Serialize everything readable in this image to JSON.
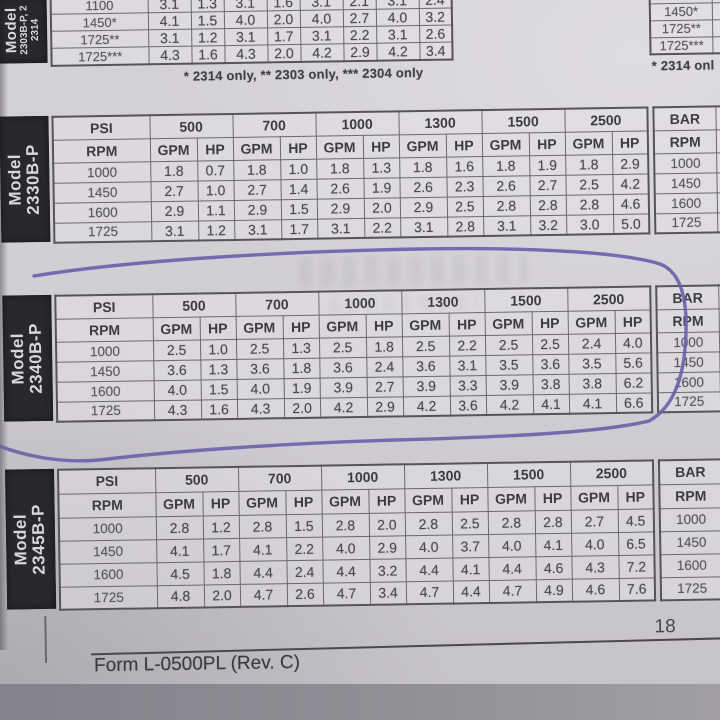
{
  "labels": {
    "psi": "PSI",
    "rpm": "RPM",
    "gpm": "GPM",
    "hp": "HP",
    "bar": "BAR"
  },
  "footnotes": {
    "top_left": "* 2314 only, ** 2303 only, *** 2304 only",
    "top_right_partial": "* 2314 onl"
  },
  "footer": {
    "form_text": "Form L-0500PL (Rev. C)",
    "page_number": "18"
  },
  "annotation": {
    "type": "hand-drawn pen circle",
    "color": "#6e62aa",
    "target": "Model 2340B-P table"
  },
  "tables": {
    "top": {
      "model_lines": [
        "Model",
        "2303B-P, 2",
        "2314"
      ],
      "rows": [
        {
          "rpm": "1100",
          "values": [
            "3.1",
            "1.3",
            "3.1",
            "1.6",
            "3.1",
            "2.1",
            "3.1",
            "2.4"
          ]
        },
        {
          "rpm": "1450*",
          "values": [
            "4.1",
            "1.5",
            "4.0",
            "2.0",
            "4.0",
            "2.7",
            "4.0",
            "3.2"
          ]
        },
        {
          "rpm": "1725**",
          "values": [
            "3.1",
            "1.2",
            "3.1",
            "1.7",
            "3.1",
            "2.2",
            "3.1",
            "2.6"
          ]
        },
        {
          "rpm": "1725***",
          "values": [
            "4.3",
            "1.6",
            "4.3",
            "2.0",
            "4.2",
            "2.9",
            "4.2",
            "3.4"
          ]
        }
      ]
    },
    "top_right": {
      "rpm_only_rows": [
        "",
        "1450*",
        "1725**",
        "1725***"
      ]
    },
    "t2330": {
      "model_lines": [
        "Model",
        "2330B-P"
      ],
      "pressures": [
        "500",
        "700",
        "1000",
        "1300",
        "1500",
        "2500"
      ],
      "rows": [
        {
          "rpm": "1000",
          "values": [
            "1.8",
            "0.7",
            "1.8",
            "1.0",
            "1.8",
            "1.3",
            "1.8",
            "1.6",
            "1.8",
            "1.9",
            "1.8",
            "2.9"
          ]
        },
        {
          "rpm": "1450",
          "values": [
            "2.7",
            "1.0",
            "2.7",
            "1.4",
            "2.6",
            "1.9",
            "2.6",
            "2.3",
            "2.6",
            "2.7",
            "2.5",
            "4.2"
          ]
        },
        {
          "rpm": "1600",
          "values": [
            "2.9",
            "1.1",
            "2.9",
            "1.5",
            "2.9",
            "2.0",
            "2.9",
            "2.5",
            "2.8",
            "2.8",
            "2.8",
            "4.6"
          ]
        },
        {
          "rpm": "1725",
          "values": [
            "3.1",
            "1.2",
            "3.1",
            "1.7",
            "3.1",
            "2.2",
            "3.1",
            "2.8",
            "3.1",
            "3.2",
            "3.0",
            "5.0"
          ]
        }
      ],
      "bar_rpm": [
        "1000",
        "1450",
        "1600",
        "1725"
      ]
    },
    "t2340": {
      "model_lines": [
        "Model",
        "2340B-P"
      ],
      "pressures": [
        "500",
        "700",
        "1000",
        "1300",
        "1500",
        "2500"
      ],
      "rows": [
        {
          "rpm": "1000",
          "values": [
            "2.5",
            "1.0",
            "2.5",
            "1.3",
            "2.5",
            "1.8",
            "2.5",
            "2.2",
            "2.5",
            "2.5",
            "2.4",
            "4.0"
          ]
        },
        {
          "rpm": "1450",
          "values": [
            "3.6",
            "1.3",
            "3.6",
            "1.8",
            "3.6",
            "2.4",
            "3.6",
            "3.1",
            "3.5",
            "3.6",
            "3.5",
            "5.6"
          ]
        },
        {
          "rpm": "1600",
          "values": [
            "4.0",
            "1.5",
            "4.0",
            "1.9",
            "3.9",
            "2.7",
            "3.9",
            "3.3",
            "3.9",
            "3.8",
            "3.8",
            "6.2"
          ]
        },
        {
          "rpm": "1725",
          "values": [
            "4.3",
            "1.6",
            "4.3",
            "2.0",
            "4.2",
            "2.9",
            "4.2",
            "3.6",
            "4.2",
            "4.1",
            "4.1",
            "6.6"
          ]
        }
      ],
      "bar_rpm": [
        "1000",
        "1450",
        "1600",
        "1725"
      ]
    },
    "t2345": {
      "model_lines": [
        "Model",
        "2345B-P"
      ],
      "pressures": [
        "500",
        "700",
        "1000",
        "1300",
        "1500",
        "2500"
      ],
      "rows": [
        {
          "rpm": "1000",
          "values": [
            "2.8",
            "1.2",
            "2.8",
            "1.5",
            "2.8",
            "2.0",
            "2.8",
            "2.5",
            "2.8",
            "2.8",
            "2.7",
            "4.5"
          ]
        },
        {
          "rpm": "1450",
          "values": [
            "4.1",
            "1.7",
            "4.1",
            "2.2",
            "4.0",
            "2.9",
            "4.0",
            "3.7",
            "4.0",
            "4.1",
            "4.0",
            "6.5"
          ]
        },
        {
          "rpm": "1600",
          "values": [
            "4.5",
            "1.8",
            "4.4",
            "2.4",
            "4.4",
            "3.2",
            "4.4",
            "4.1",
            "4.4",
            "4.6",
            "4.3",
            "7.2"
          ]
        },
        {
          "rpm": "1725",
          "values": [
            "4.8",
            "2.0",
            "4.7",
            "2.6",
            "4.7",
            "3.4",
            "4.7",
            "4.4",
            "4.7",
            "4.9",
            "4.6",
            "7.6"
          ]
        }
      ],
      "bar_rpm": [
        "1000",
        "1450",
        "1600",
        "1725"
      ]
    }
  }
}
